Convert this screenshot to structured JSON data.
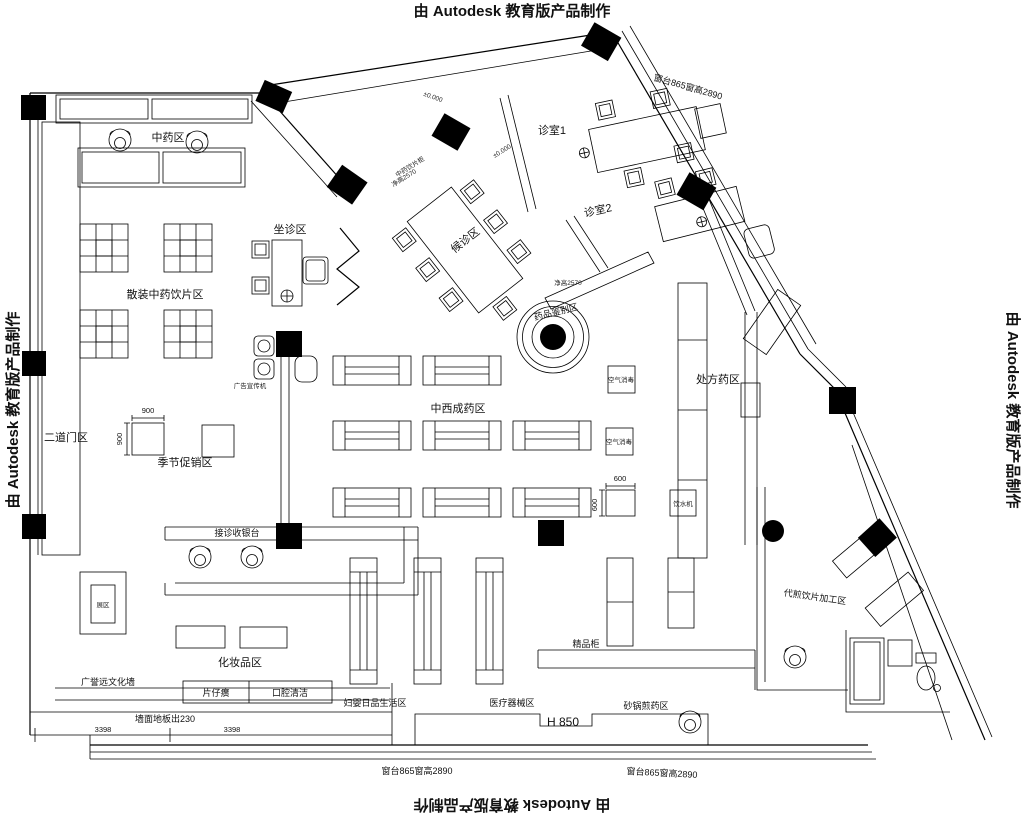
{
  "watermark": {
    "text": "由 Autodesk 教育版产品制作"
  },
  "areas": {
    "zhongyao": "中药区",
    "sanzhuang": "散装中药饮片区",
    "zuozhen": "坐诊区",
    "houzhen": "候诊区",
    "zhenshi1": "诊室1",
    "zhenshi2": "诊室2",
    "erdaomen": "二道门区",
    "jijie": "季节促销区",
    "jiezhen": "接诊收银台",
    "huazhuang": "化妆品区",
    "wenhua": "广誉远文化墙",
    "fuying": "妇婴日品生活区",
    "yiliao": "医疗器械区",
    "jingpin": "精品柜",
    "shaguo": "砂锅煎药区",
    "jiagong": "代煎饮片加工区",
    "zhongxi": "中西成药区",
    "chufang": "处方药区",
    "jianbie": "药品鉴别区",
    "zhanqu": "展区",
    "pianzihuang": "片仔癀",
    "kouqiang": "口腔清洁"
  },
  "annotations": {
    "chuangtai": "窗台865窗高2890",
    "qiangmian": "墙面地板出230",
    "h850": "H 850",
    "jinggao": "净高2570",
    "yinpiangui": "中药饮片柜",
    "lingbiao": "±0.000",
    "kongqi": "空气消毒",
    "yinshui": "饮水机",
    "guanggao": "广告宣传机"
  },
  "dimensions": {
    "d900": "900",
    "d600": "600",
    "d3398": "3398"
  }
}
